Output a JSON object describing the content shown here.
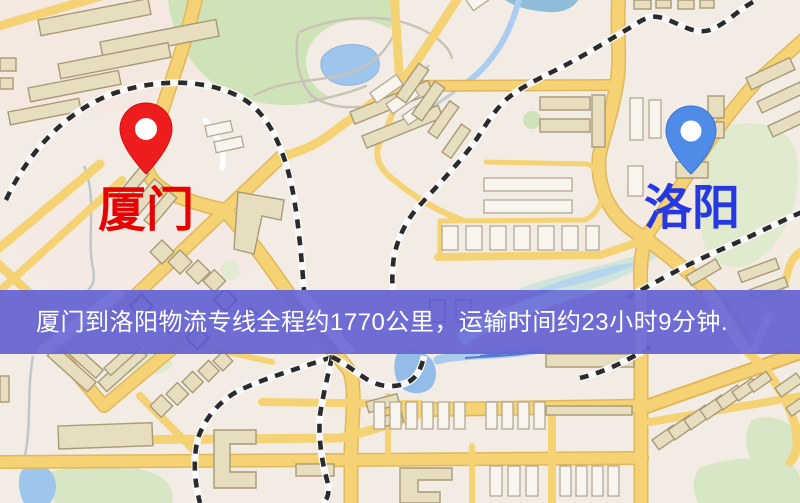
{
  "map": {
    "description": "静态物流专线地图截图",
    "markers": [
      {
        "id": "xiamen",
        "label": "厦门",
        "pin_color": "#ee1c1c",
        "pin_stroke": "#d01010",
        "label_color": "#e60200"
      },
      {
        "id": "luoyang",
        "label": "洛阳",
        "pin_color": "#4f8ce8",
        "pin_stroke": "#3a72cc",
        "label_color": "#2638e2"
      }
    ],
    "caption": {
      "text": "厦门到洛阳物流专线全程约1770公里，运输时间约23小时9分钟.",
      "band_color": "#6765d3",
      "text_color": "#ffffff",
      "distance_km": "1770",
      "duration": "23小时9分钟"
    },
    "palette": {
      "background": "#f3ece4",
      "road": "#f5d274",
      "road_casing": "#e2b75c",
      "water": "#9ec6ec",
      "park": "#cfe3b8",
      "building": "#e7ddbf",
      "railway": "#2b2b2b"
    }
  }
}
